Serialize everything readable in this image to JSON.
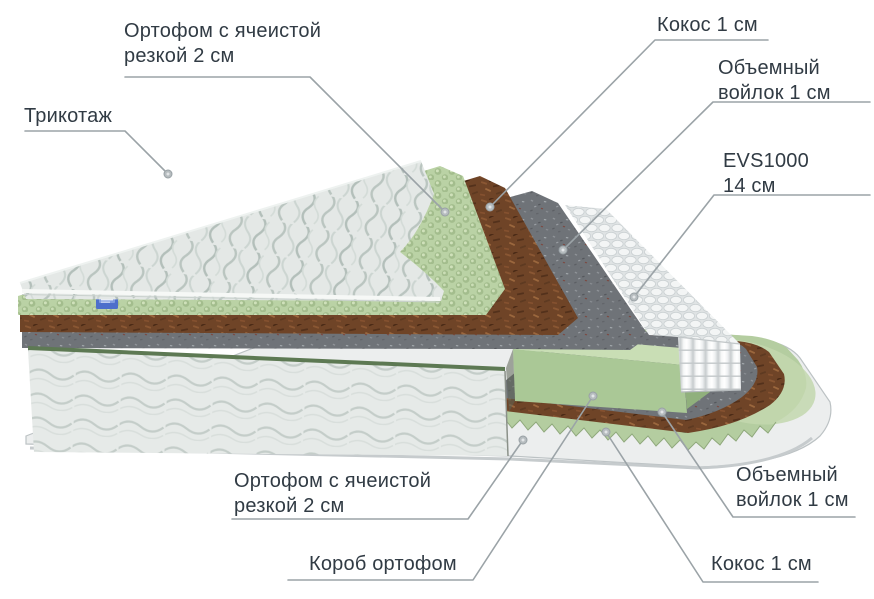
{
  "title": "Mattress layers diagram",
  "labels": {
    "ortofom_top": {
      "line1": "Ортофом с ячеистой",
      "line2": "резкой 2 см"
    },
    "trikotazh": {
      "line1": "Трикотаж"
    },
    "kokos_top": {
      "line1": "Кокос 1 см"
    },
    "voilok_top": {
      "line1": "Объемный",
      "line2": "войлок 1 см"
    },
    "evs": {
      "line1": "EVS1000",
      "line2": "14 см"
    },
    "ortofom_bottom": {
      "line1": "Ортофом с ячеистой",
      "line2": "резкой 2 см"
    },
    "korob": {
      "line1": "Короб ортофом"
    },
    "voilok_bottom": {
      "line1": "Объемный",
      "line2": "войлок 1 см"
    },
    "kokos_bottom": {
      "line1": "Кокос 1 см"
    }
  },
  "palette": {
    "text": "#313b44",
    "leader_line": "#9ba3a7",
    "fabric": "#e4e8e6",
    "egg_foam_green": "#bad2a5",
    "coconut_brown": "#6f4427",
    "felt_grey": "#6f7378",
    "springs_white": "#f3f5f5",
    "foam_box_green": "#aac896",
    "body_top_green": "#5d7953",
    "tray_grey": "#eceeee",
    "tag_blue": "#4d6fcb"
  }
}
